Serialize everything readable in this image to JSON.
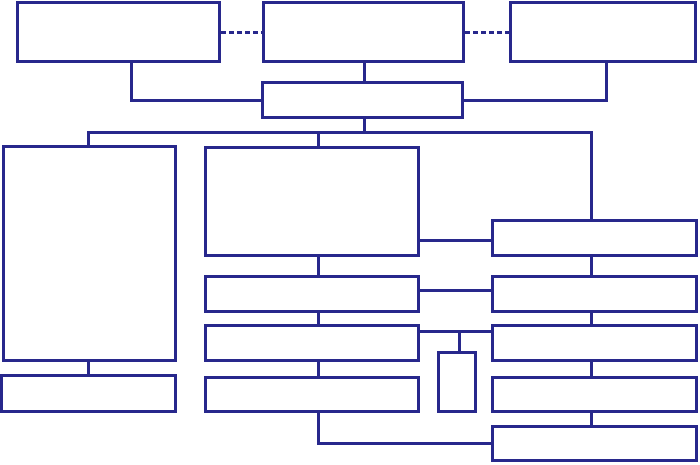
{
  "diagram": {
    "type": "org-chart-flowchart-template",
    "title": "",
    "canvas": {
      "width": 700,
      "height": 465,
      "background": "#ffffff"
    },
    "style": {
      "line_color": "#28288C",
      "line_width": 3,
      "node_fill": "#ffffff",
      "dashed_link_pattern": "5px dash, 3px gap"
    },
    "boxes": [
      {
        "id": "top-left-box",
        "label": "",
        "x": 16,
        "y": 1,
        "w": 205,
        "h": 62
      },
      {
        "id": "top-center-box",
        "label": "",
        "x": 262,
        "y": 1,
        "w": 203,
        "h": 62
      },
      {
        "id": "top-right-box",
        "label": "",
        "x": 509,
        "y": 1,
        "w": 188,
        "h": 62
      },
      {
        "id": "secondary-center-box",
        "label": "",
        "x": 261,
        "y": 81,
        "w": 203,
        "h": 38
      },
      {
        "id": "left-tall-box",
        "label": "",
        "x": 2,
        "y": 145,
        "w": 175,
        "h": 217
      },
      {
        "id": "left-bottom-bar",
        "label": "",
        "x": 0,
        "y": 374,
        "w": 177,
        "h": 39
      },
      {
        "id": "center-large-box",
        "label": "",
        "x": 204,
        "y": 146,
        "w": 216,
        "h": 111
      },
      {
        "id": "center-bar-1",
        "label": "",
        "x": 204,
        "y": 275,
        "w": 216,
        "h": 38
      },
      {
        "id": "center-bar-2",
        "label": "",
        "x": 204,
        "y": 324,
        "w": 216,
        "h": 38
      },
      {
        "id": "center-bar-3",
        "label": "",
        "x": 204,
        "y": 376,
        "w": 216,
        "h": 37
      },
      {
        "id": "small-vertical-box",
        "label": "",
        "x": 437,
        "y": 351,
        "w": 40,
        "h": 62
      },
      {
        "id": "right-bar-1",
        "label": "",
        "x": 491,
        "y": 219,
        "w": 207,
        "h": 38
      },
      {
        "id": "right-bar-2",
        "label": "",
        "x": 491,
        "y": 275,
        "w": 207,
        "h": 38
      },
      {
        "id": "right-bar-3",
        "label": "",
        "x": 491,
        "y": 324,
        "w": 207,
        "h": 38
      },
      {
        "id": "right-bar-4",
        "label": "",
        "x": 491,
        "y": 376,
        "w": 207,
        "h": 37
      },
      {
        "id": "right-bar-5",
        "label": "",
        "x": 491,
        "y": 425,
        "w": 207,
        "h": 37
      }
    ],
    "connectors": [
      {
        "id": "dashed-link-left",
        "kind": "h-dashed",
        "x": 221,
        "y": 31,
        "len": 41
      },
      {
        "id": "dashed-link-right",
        "kind": "h-dashed",
        "x": 465,
        "y": 31,
        "len": 44
      },
      {
        "id": "top-left-drop",
        "kind": "v",
        "x": 130,
        "y": 62,
        "len": 40
      },
      {
        "id": "top-left-elbow",
        "kind": "h",
        "x": 130,
        "y": 99,
        "len": 133
      },
      {
        "id": "top-center-drop",
        "kind": "v",
        "x": 363,
        "y": 62,
        "len": 21
      },
      {
        "id": "top-right-drop",
        "kind": "v",
        "x": 605,
        "y": 62,
        "len": 40
      },
      {
        "id": "top-right-elbow",
        "kind": "h",
        "x": 462,
        "y": 99,
        "len": 146
      },
      {
        "id": "secondary-drop",
        "kind": "v",
        "x": 363,
        "y": 117,
        "len": 17
      },
      {
        "id": "distribution-line",
        "kind": "h",
        "x": 87,
        "y": 131,
        "len": 506
      },
      {
        "id": "left-branch-drop",
        "kind": "v",
        "x": 87,
        "y": 131,
        "len": 16
      },
      {
        "id": "center-branch-drop",
        "kind": "v",
        "x": 317,
        "y": 131,
        "len": 17
      },
      {
        "id": "right-branch-drop",
        "kind": "v",
        "x": 590,
        "y": 131,
        "len": 90
      },
      {
        "id": "center-to-right-link-1",
        "kind": "h",
        "x": 418,
        "y": 239,
        "len": 75
      },
      {
        "id": "center-stub-1",
        "kind": "v",
        "x": 317,
        "y": 255,
        "len": 22
      },
      {
        "id": "center-to-right-link-2",
        "kind": "h",
        "x": 418,
        "y": 289,
        "len": 75
      },
      {
        "id": "center-stub-2",
        "kind": "v",
        "x": 317,
        "y": 311,
        "len": 15
      },
      {
        "id": "center-to-right-link-3",
        "kind": "h",
        "x": 418,
        "y": 330,
        "len": 75
      },
      {
        "id": "small-box-drop",
        "kind": "v",
        "x": 458,
        "y": 330,
        "len": 23
      },
      {
        "id": "center-stub-3",
        "kind": "v",
        "x": 317,
        "y": 360,
        "len": 18
      },
      {
        "id": "center-bottom-drop",
        "kind": "v",
        "x": 317,
        "y": 411,
        "len": 34
      },
      {
        "id": "bottom-link",
        "kind": "h",
        "x": 317,
        "y": 442,
        "len": 176
      },
      {
        "id": "right-stub-1",
        "kind": "v",
        "x": 590,
        "y": 255,
        "len": 22
      },
      {
        "id": "right-stub-2",
        "kind": "v",
        "x": 590,
        "y": 311,
        "len": 15
      },
      {
        "id": "right-stub-3",
        "kind": "v",
        "x": 590,
        "y": 360,
        "len": 18
      },
      {
        "id": "right-stub-4",
        "kind": "v",
        "x": 590,
        "y": 411,
        "len": 16
      },
      {
        "id": "left-bottom-stub",
        "kind": "v",
        "x": 87,
        "y": 360,
        "len": 16
      }
    ]
  }
}
